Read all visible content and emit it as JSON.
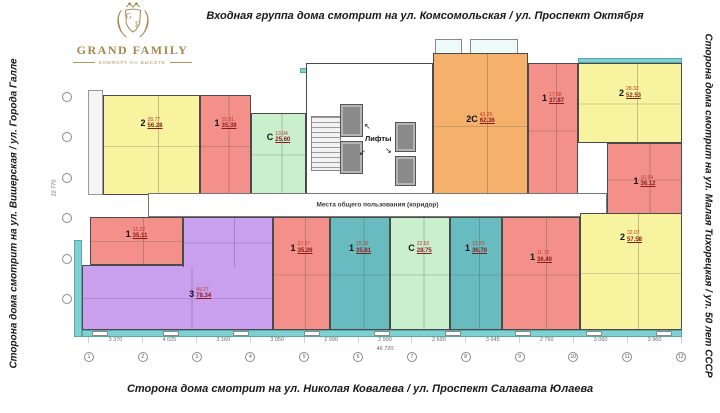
{
  "titles": {
    "top": "Входная группа дома смотрит на ул. Комсомольская / ул. Проспект Октября",
    "bottom": "Сторона дома смотрит на ул. Николая Ковалева / ул. Проспект Салавата Юлаева",
    "left": "Сторона дома смотрит на ул. Вишерская / ул. Города Галле",
    "right": "Сторона дома смотрит на ул. Малая Тихорецкая / ул. 50 лет СССР"
  },
  "logo": {
    "name": "GRAND FAMILY",
    "tagline": "КОМФОРТ НА ВЫСОТЕ",
    "monogram_left": "G",
    "monogram_right": "F"
  },
  "palette": {
    "one_room_red": "#f29089",
    "two_room_yellow": "#f8f39e",
    "studio_green": "#c9efcc",
    "one_room_teal": "#68bcbf",
    "two_room_orange": "#f5b06c",
    "three_room_purple": "#c9a0ee",
    "balcony_teal": "#7fd0d0",
    "logo_bronze": "#a8864e"
  },
  "plan": {
    "elevators_label": "Лифты",
    "corridor_label": "Места общего пользования (коридор)",
    "apartments": [
      {
        "rooms": "2",
        "living": "28.77",
        "total": "56.28"
      },
      {
        "rooms": "1",
        "living": "15.51",
        "total": "35.39"
      },
      {
        "rooms": "С",
        "living": "13.04",
        "total": "25.60"
      },
      {
        "rooms": "2С",
        "living": "43.25",
        "total": "62.36"
      },
      {
        "rooms": "1",
        "living": "17.88",
        "total": "37.87"
      },
      {
        "rooms": "2",
        "living": "28.32",
        "total": "52.53"
      },
      {
        "rooms": "1",
        "living": "16.64",
        "total": "36.12"
      },
      {
        "rooms": "1",
        "living": "15.22",
        "total": "35.11"
      },
      {
        "rooms": "3",
        "living": "49.27",
        "total": "78.34"
      },
      {
        "rooms": "1",
        "living": "17.27",
        "total": "35.26"
      },
      {
        "rooms": "1",
        "living": "15.32",
        "total": "35.81"
      },
      {
        "rooms": "С",
        "living": "22.92",
        "total": "28.75"
      },
      {
        "rooms": "1",
        "living": "13.70",
        "total": "36.70"
      },
      {
        "rooms": "1",
        "living": "11.72",
        "total": "36.40"
      },
      {
        "rooms": "2",
        "living": "32.07",
        "total": "57.58"
      }
    ],
    "axes": [
      "1",
      "2",
      "3",
      "4",
      "5",
      "6",
      "7",
      "8",
      "9",
      "10",
      "11",
      "12"
    ],
    "dimensions": [
      "3 370",
      "4 025",
      "3 160",
      "3 050",
      "2 990",
      "2 990",
      "2 690",
      "3 645",
      "2 760",
      "3 060",
      "3 960"
    ],
    "total_length": "46 720",
    "left_dimension": "22 770"
  }
}
